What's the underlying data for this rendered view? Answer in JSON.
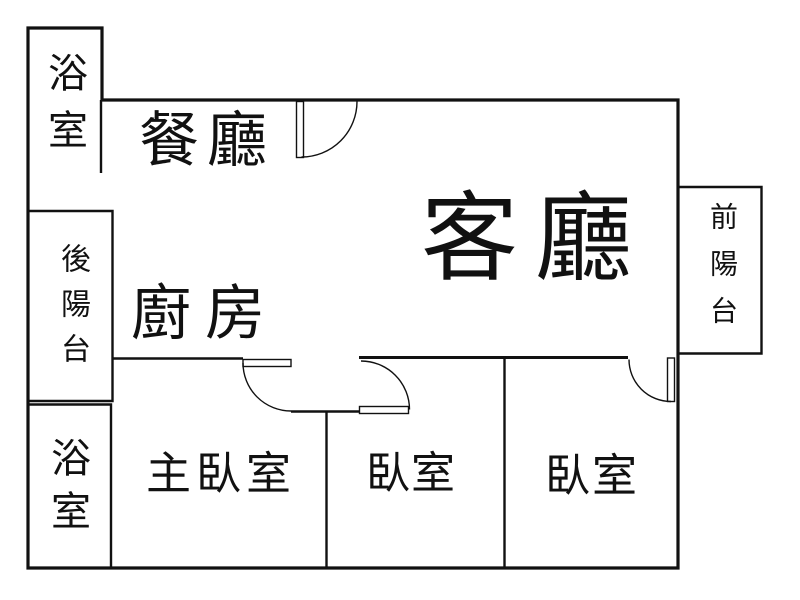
{
  "floor_plan": {
    "background_color": "#ffffff",
    "wall_color": "#111111",
    "rooms": [
      {
        "key": "bathroom-top",
        "label": "浴室",
        "orientation": "vertical"
      },
      {
        "key": "dining-room",
        "label": "餐廳",
        "orientation": "horizontal"
      },
      {
        "key": "back-balcony",
        "label": "後陽台",
        "orientation": "vertical"
      },
      {
        "key": "kitchen",
        "label": "廚房",
        "orientation": "horizontal"
      },
      {
        "key": "living-room",
        "label": "客廳",
        "orientation": "horizontal"
      },
      {
        "key": "front-balcony",
        "label": "前陽台",
        "orientation": "vertical"
      },
      {
        "key": "bathroom-bottom",
        "label": "浴室",
        "orientation": "vertical"
      },
      {
        "key": "master-bedroom",
        "label": "主臥室",
        "orientation": "horizontal"
      },
      {
        "key": "bedroom-middle",
        "label": "臥室",
        "orientation": "horizontal"
      },
      {
        "key": "bedroom-right",
        "label": "臥室",
        "orientation": "horizontal"
      }
    ],
    "door_icons": [
      "door-swing-icon-dining-entry",
      "door-swing-icon-master-bedroom",
      "door-swing-icon-bedroom-middle",
      "door-swing-icon-bedroom-right"
    ]
  }
}
